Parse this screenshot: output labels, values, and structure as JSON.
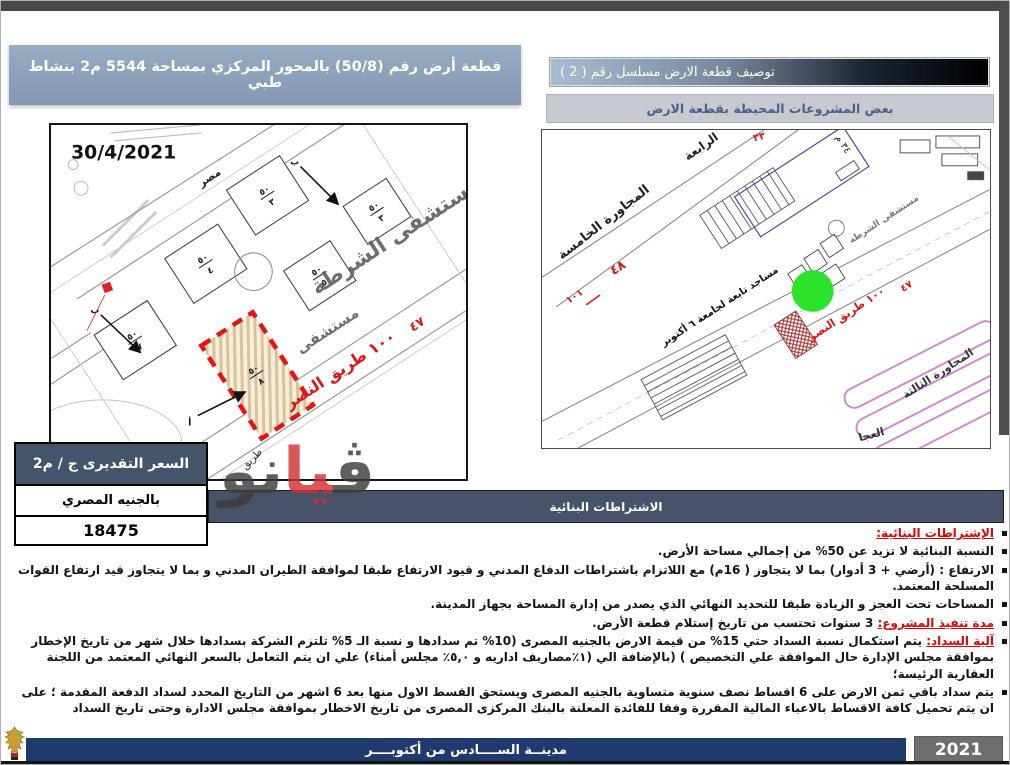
{
  "banners": {
    "plot_title": "قطعة أرض رقم (50/8) بالمحور المركزي بمساحة 5544 م2 بنشاط طبي",
    "description_title": "توصيف قطعة الارض مسلسل رقم ( 2  )",
    "projects_title": "بعض المشروعات المحيطة بقطعة الارض",
    "building_title": "الاشتراطات البنائية"
  },
  "left_map": {
    "date": "30/4/2021",
    "hospital": "مستشفى الشرطة",
    "hospital_partial": "مستشفى",
    "egypt": "مصر",
    "road": "طريق",
    "nasr_road": "١٠٠ طريق النصر",
    "num_47": "٤٧",
    "arrow_b": "ب",
    "arrow_a": "أ",
    "plots": [
      {
        "top": "٥٠",
        "bottom": "٣"
      },
      {
        "top": "٥٠",
        "bottom": "٤"
      },
      {
        "top": "٥٠",
        "bottom": "٧"
      },
      {
        "top": "٥٠",
        "bottom": "٥"
      },
      {
        "top": "٥٠",
        "bottom": "٣"
      },
      {
        "top": "٥٠",
        "bottom": "٨"
      }
    ]
  },
  "right_map": {
    "n5": "المجاورة الخامسة",
    "n4": "الرابعة",
    "n3": "المجاورة الثالثة",
    "mosques": "مساجد تابعة لجامعة ٦ أكتوبر",
    "hospital": "مستشفى الشرطة",
    "nasr_road": "١٠٠ طريق النصر",
    "num48": "٤٨",
    "num101": "١٠١",
    "num47": "٤٧",
    "num33": "٣٣",
    "num34": "٣٤ م",
    "partial_bottom": "العجا"
  },
  "price": {
    "header": "السعر التقديرى ج / م2",
    "currency": "بالجنيه المصري",
    "value": "18475"
  },
  "conditions": {
    "items": [
      {
        "header": "الإشتراطات البنائية:",
        "text": ""
      },
      {
        "header": "",
        "text": "النسبة البنائية لا تزيد عن 50% من إجمالي مساحة الأرض."
      },
      {
        "header": "",
        "text": "الارتفاع : (أرضي + 3 أدوار) بما لا يتجاوز ( 16م) مع اللاتزام باشتراطات الدفاع المدني و قيود الارتفاع طبقا لموافقة الطيران المدني و بما لا يتجاوز قيد ارتفاع القوات المسلحة المعتمد."
      },
      {
        "header": "",
        "text": "المساحات تحت العجز و الزيادة طبقا للتحديد النهائي الذي يصدر من إدارة المساحة بجهاز المدينة."
      },
      {
        "header": "مدة تنفيذ المشروع:",
        "text": " 3 سنوات تحتسب من تاريخ إستلام قطعة الأرض."
      },
      {
        "header": "آلية السداد:",
        "text": "  يتم استكمال نسبة السداد حتي 15% من قيمة الارض بالجنيه المصرى   (10% تم سدادها و نسبة الـ 5% تلتزم الشركة بسدادها خلال شهر من تاريخ الإخطار بموافقة مجلس الإدارة حال الموافقة علي التخصيص ) (بالإضافة الي (١٪مصاريف اداريه و ٥,٠٪ مجلس أمناء) علي ان يتم التعامل بالسعر النهائي المعتمد من اللجنة العقارية الرئيسة؛"
      },
      {
        "header": "",
        "text": "يتم سداد باقي ثمن الارض على 6 اقساط نصف سنوية متساوية بالجنيه المصرى ويستحق القسط الاول منها بعد 6 اشهر من التاريخ المحدد لسداد الدفعة المقدمة ؛ على ان يتم تحميل كافة الاقساط بالاعباء المالية المقررة وفقا للفائدة المعلنة بالبنك المركزى المصرى من تاريخ الاخطار بموافقة مجلس الادارة وحتى تاريخ السداد"
      }
    ]
  },
  "watermark": {
    "p1": "ڤ",
    "p2": "يا",
    "p3": "نو"
  },
  "footer": {
    "city": "مدينــة الســــادس من أكتوبــــر",
    "year": "2021"
  }
}
